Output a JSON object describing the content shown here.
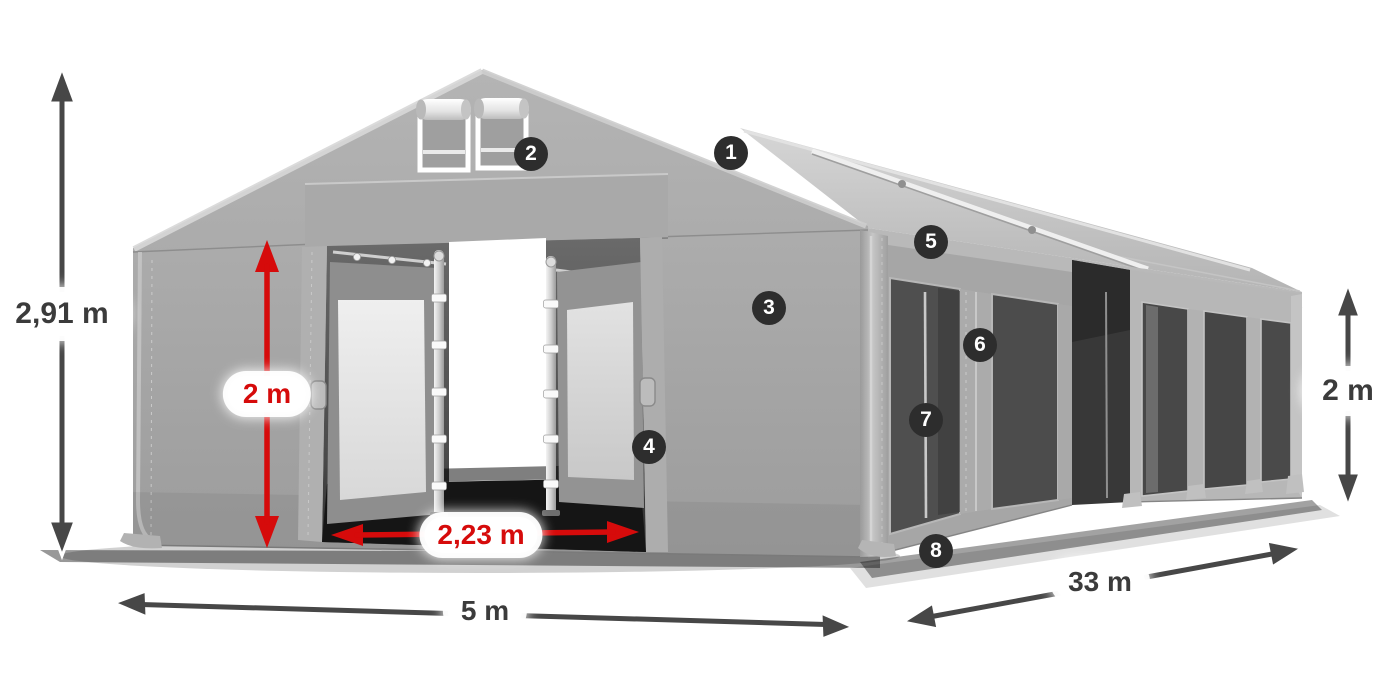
{
  "diagram": {
    "type": "product-dimension-diagram",
    "subject": "Gray marquee storage tent shown in perspective with dimension arrows and numbered feature hotspots",
    "background": "#ffffff",
    "colors": {
      "fabric_gray": "#a6a6a6",
      "window_mesh_dark": "#4c4c4c",
      "dimension_arrow_dark": "#474747",
      "dimension_accent_red": "#d60b0b",
      "label_pill_bg": "#ffffff",
      "label_text_dark": "#3b3b3b",
      "hotspot_bg": "#2d2d2d",
      "hotspot_text": "#ffffff"
    }
  },
  "dimensions": [
    {
      "id": "total-height",
      "label": "2,91 m",
      "color_style": "dark"
    },
    {
      "id": "entrance-height",
      "label": "2 m",
      "color_style": "red"
    },
    {
      "id": "entrance-width",
      "label": "2,23 m",
      "color_style": "red"
    },
    {
      "id": "front-width",
      "label": "5 m",
      "color_style": "dark"
    },
    {
      "id": "side-length",
      "label": "33 m",
      "color_style": "dark"
    },
    {
      "id": "side-height",
      "label": "2 m",
      "color_style": "dark"
    }
  ],
  "hotspots": [
    {
      "number": "1"
    },
    {
      "number": "2"
    },
    {
      "number": "3"
    },
    {
      "number": "4"
    },
    {
      "number": "5"
    },
    {
      "number": "6"
    },
    {
      "number": "7"
    },
    {
      "number": "8"
    }
  ]
}
